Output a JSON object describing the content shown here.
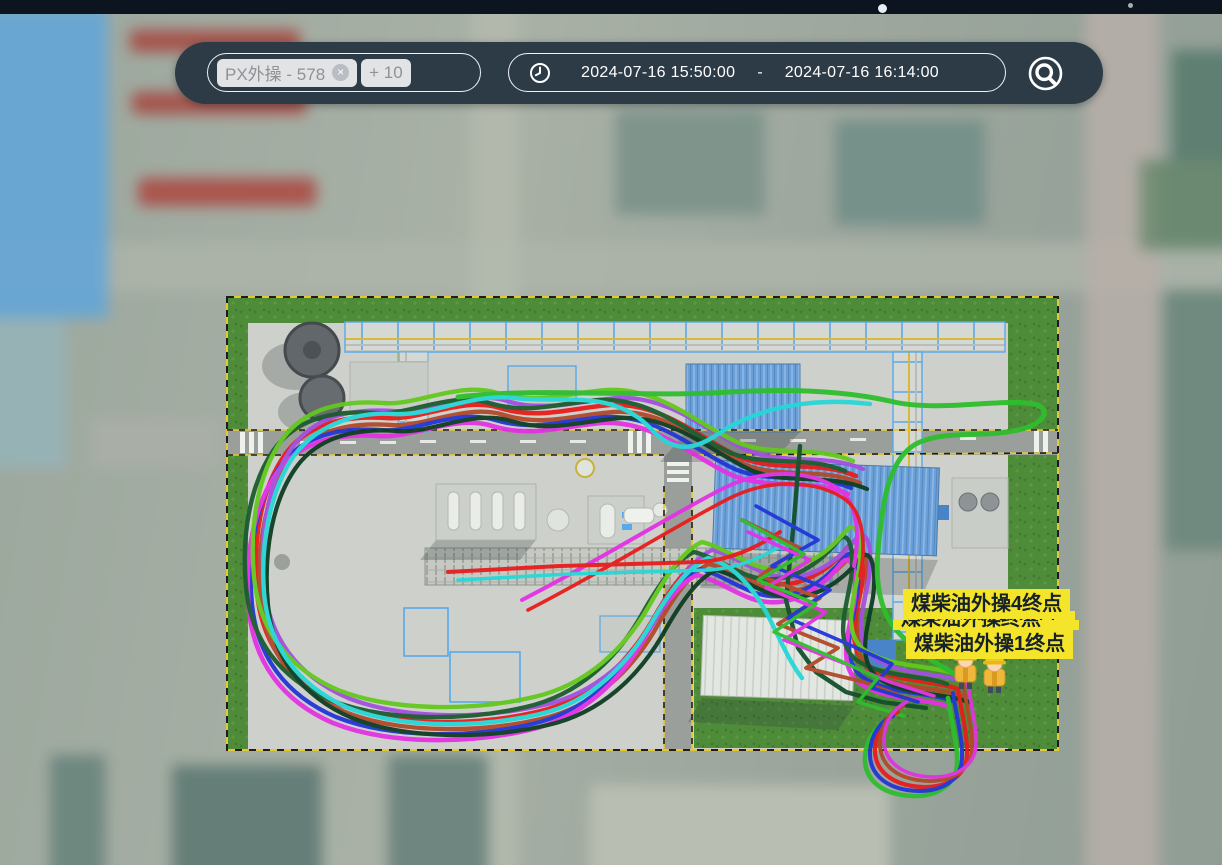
{
  "toolbar": {
    "search": {
      "tag": "PX外操 - 578",
      "remove_glyph": "×",
      "more_count": "+ 10"
    },
    "time_range": {
      "start": "2024-07-16 15:50:00",
      "separator": "-",
      "end": "2024-07-16 16:14:00"
    },
    "icons": {
      "clock": "clock-icon",
      "locate": "magnifier-target-icon"
    }
  },
  "map": {
    "endpoint_labels": {
      "top": "煤柴油外操4终点",
      "obscured_a": "煤柴油外操终点",
      "obscured_b": "煤柴油外操终点",
      "bottom": "煤柴油外操1终点"
    },
    "worker_count": 2,
    "label_bg": "#f4e42a",
    "trail_bases": {
      "loop": "M856,476 C818,460 778,472 742,458 C704,442 664,402 610,405 C570,408 540,420 500,408 C462,396 420,421 386,418 C344,415 306,424 284,456 C262,488 252,538 257,592 C262,644 290,683 341,705 C397,727 477,726 537,712 C590,700 628,663 652,621 C670,589 687,565 705,557 C729,563 751,582 775,584 C803,587 830,569 848,547 C860,531 866,556 862,584 C856,618 846,646 866,664 C892,683 930,679 958,689",
      "below": "M958,689 C962,716 970,744 966,762 C960,782 938,790 912,786 C888,782 874,768 875,748 C876,730 886,717 898,712",
      "greentop": "M458,397 C540,387 640,398 730,392 C800,388 852,392 894,402 C940,412 1002,398 1034,404 C1052,408 1046,424 1018,430 C984,438 948,430 920,442 C896,452 886,484 882,516 C878,548 872,582 886,614 C898,640 930,660 958,676",
      "cyanpath": "M870,404 C820,398 762,404 718,434 C692,452 672,452 650,428 C612,388 562,404 514,398 C472,393 432,416 394,414 C352,411 312,428 291,460 C272,490 260,540 264,592 C268,644 296,684 346,707 C401,729 480,728 540,714 C592,702 628,664 652,622 C670,590 690,566 708,558 C732,564 752,586 766,612 C778,634 788,660 802,678",
      "diag": "M522,600 C600,560 676,512 724,488 C764,468 812,470 840,490 C858,504 860,536 854,566",
      "rackline": "M448,572 L560,566 L700,562 C730,560 756,548 780,532",
      "spike": "M800,446 L794,520 L786,600 L798,648 L816,672 L846,692 L882,702 L926,708",
      "s1": "M742,520 L800,548 L760,576 L820,598 L778,624 L838,648 L806,668 L864,682 L912,700",
      "s2": "M756,506 L818,540 L772,566 L830,590 L788,618 L848,644 L892,664 L872,688 L918,702",
      "s3": "M748,532 L810,560 L766,588 L826,612 L784,640 L846,664 L890,682 L934,696"
    },
    "trails": [
      {
        "base": "loop",
        "color": "#e81d1d",
        "w": 4.6,
        "dx": 0,
        "dy": 0
      },
      {
        "base": "loop",
        "color": "#b14a2a",
        "w": 4.4,
        "dx": 4,
        "dy": 7
      },
      {
        "base": "loop",
        "color": "#2336d6",
        "w": 4.2,
        "dx": -5,
        "dy": 12
      },
      {
        "base": "loop",
        "color": "#e332e3",
        "w": 4.6,
        "dx": -8,
        "dy": 18
      },
      {
        "base": "loop",
        "color": "#a44fe0",
        "w": 4.2,
        "dx": 7,
        "dy": -7
      },
      {
        "base": "loop",
        "color": "#1c5c30",
        "w": 4.4,
        "dx": -11,
        "dy": -5
      },
      {
        "base": "loop",
        "color": "#0e3d22",
        "w": 4.2,
        "dx": 11,
        "dy": 13
      },
      {
        "base": "loop",
        "color": "#62c81e",
        "w": 4.4,
        "dx": -3,
        "dy": -15
      },
      {
        "base": "greentop",
        "color": "#2ebe2e",
        "w": 5,
        "dx": 0,
        "dy": 0
      },
      {
        "base": "cyanpath",
        "color": "#26d7d7",
        "w": 4.4,
        "dx": 0,
        "dy": 0
      },
      {
        "base": "diag",
        "color": "#e332e3",
        "w": 4,
        "dx": 0,
        "dy": 0
      },
      {
        "base": "diag",
        "color": "#e81d1d",
        "w": 3.6,
        "dx": 6,
        "dy": 10
      },
      {
        "base": "rackline",
        "color": "#e81d1d",
        "w": 4,
        "dx": 0,
        "dy": 0
      },
      {
        "base": "rackline",
        "color": "#26d7d7",
        "w": 3.6,
        "dx": 10,
        "dy": 8
      },
      {
        "base": "spike",
        "color": "#14502c",
        "w": 4.4,
        "dx": 0,
        "dy": 0
      },
      {
        "base": "s1",
        "color": "#b14a2a",
        "w": 3.8,
        "dx": 0,
        "dy": 0
      },
      {
        "base": "s2",
        "color": "#2336d6",
        "w": 3.6,
        "dx": 0,
        "dy": 0
      },
      {
        "base": "s3",
        "color": "#e332e3",
        "w": 3.6,
        "dx": 0,
        "dy": 0
      },
      {
        "base": "s2",
        "color": "#2ebe2e",
        "w": 3.4,
        "dx": -14,
        "dy": 14
      },
      {
        "base": "below",
        "color": "#e81d1d",
        "w": 4.2,
        "dx": 0,
        "dy": 0
      },
      {
        "base": "below",
        "color": "#2ebe2e",
        "w": 4.6,
        "dx": -10,
        "dy": 9
      },
      {
        "base": "below",
        "color": "#2336d6",
        "w": 4,
        "dx": -5,
        "dy": 4
      },
      {
        "base": "below",
        "color": "#b14a2a",
        "w": 3.8,
        "dx": 5,
        "dy": -6
      },
      {
        "base": "below",
        "color": "#e332e3",
        "w": 3.6,
        "dx": 9,
        "dy": -10
      }
    ]
  }
}
